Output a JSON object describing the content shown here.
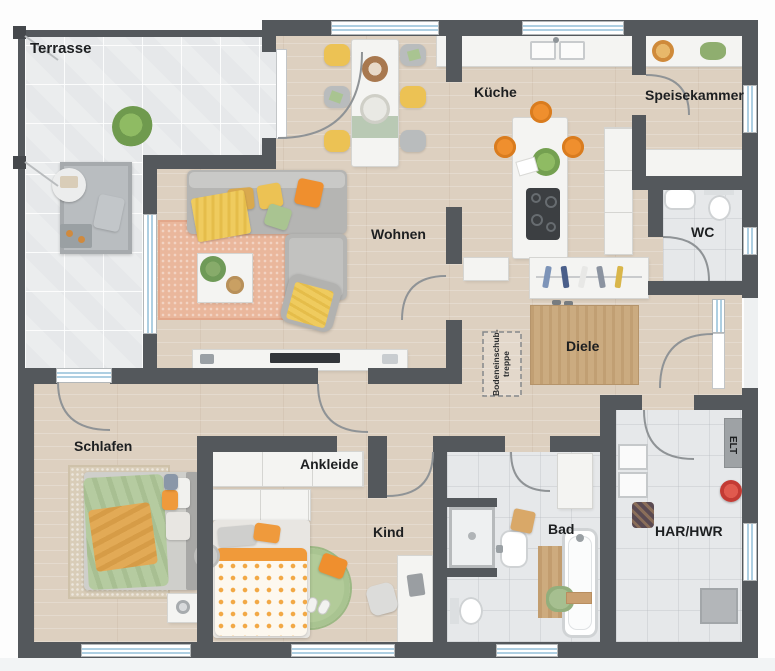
{
  "plan": {
    "rooms": [
      {
        "id": "terrasse",
        "label": "Terrasse"
      },
      {
        "id": "wohnen",
        "label": "Wohnen"
      },
      {
        "id": "kueche",
        "label": "Küche"
      },
      {
        "id": "speisekammer",
        "label": "Speisekammer"
      },
      {
        "id": "wc",
        "label": "WC"
      },
      {
        "id": "diele",
        "label": "Diele"
      },
      {
        "id": "schlafen",
        "label": "Schlafen"
      },
      {
        "id": "ankleide",
        "label": "Ankleide"
      },
      {
        "id": "kind",
        "label": "Kind"
      },
      {
        "id": "bad",
        "label": "Bad"
      },
      {
        "id": "har_hwr",
        "label": "HAR/HWR"
      },
      {
        "id": "elt",
        "label": "ELT"
      }
    ],
    "annotations": {
      "attic_stair_line1": "Bodeneinschub-",
      "attic_stair_line2": "treppe"
    },
    "colors": {
      "wall": "#54585c",
      "wood_floor": "#ddd0c0",
      "tile_floor": "#e6e8ea",
      "terrace_floor": "#ebedee",
      "window_glass": "#aecfe2",
      "accent_orange": "#ef8f2e",
      "accent_yellow": "#ecc254",
      "accent_green": "#a9c491",
      "rug_salmon": "#eab79c",
      "rug_tan": "#c8a77c"
    }
  }
}
